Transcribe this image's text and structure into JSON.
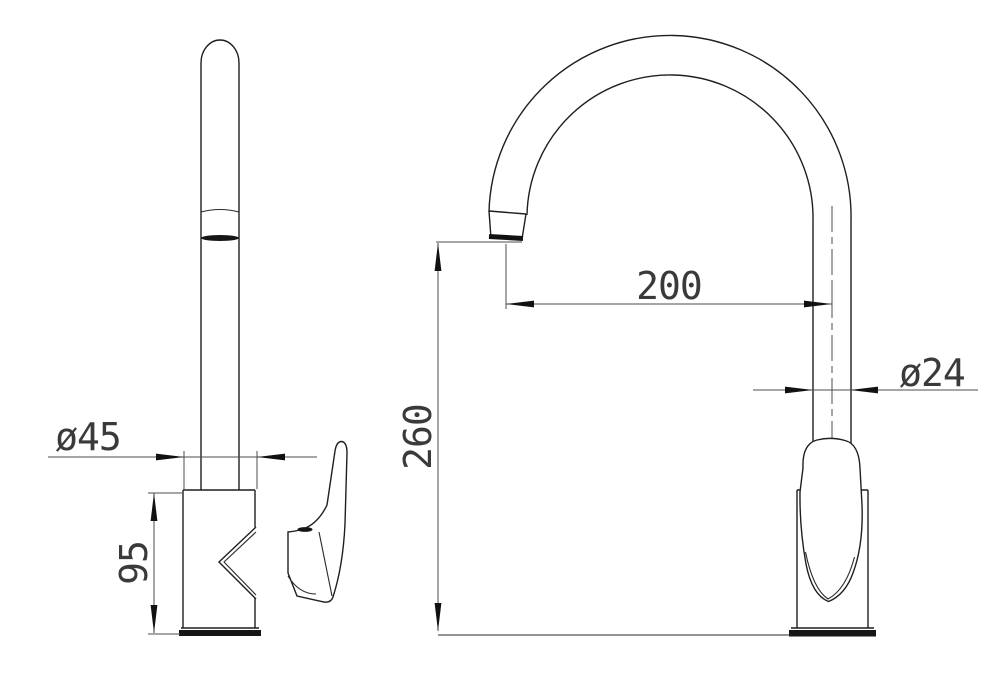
{
  "drawing": {
    "side_view": {
      "dim_diameter": "ø45",
      "dim_height": "95"
    },
    "front_view": {
      "dim_reach": "200",
      "dim_height": "260",
      "dim_diameter": "ø24"
    }
  },
  "colors": {
    "background": "#ffffff",
    "object_line": "#1f1f1f",
    "dimension_line": "#4d4d4d",
    "text": "#3a3a3a"
  }
}
